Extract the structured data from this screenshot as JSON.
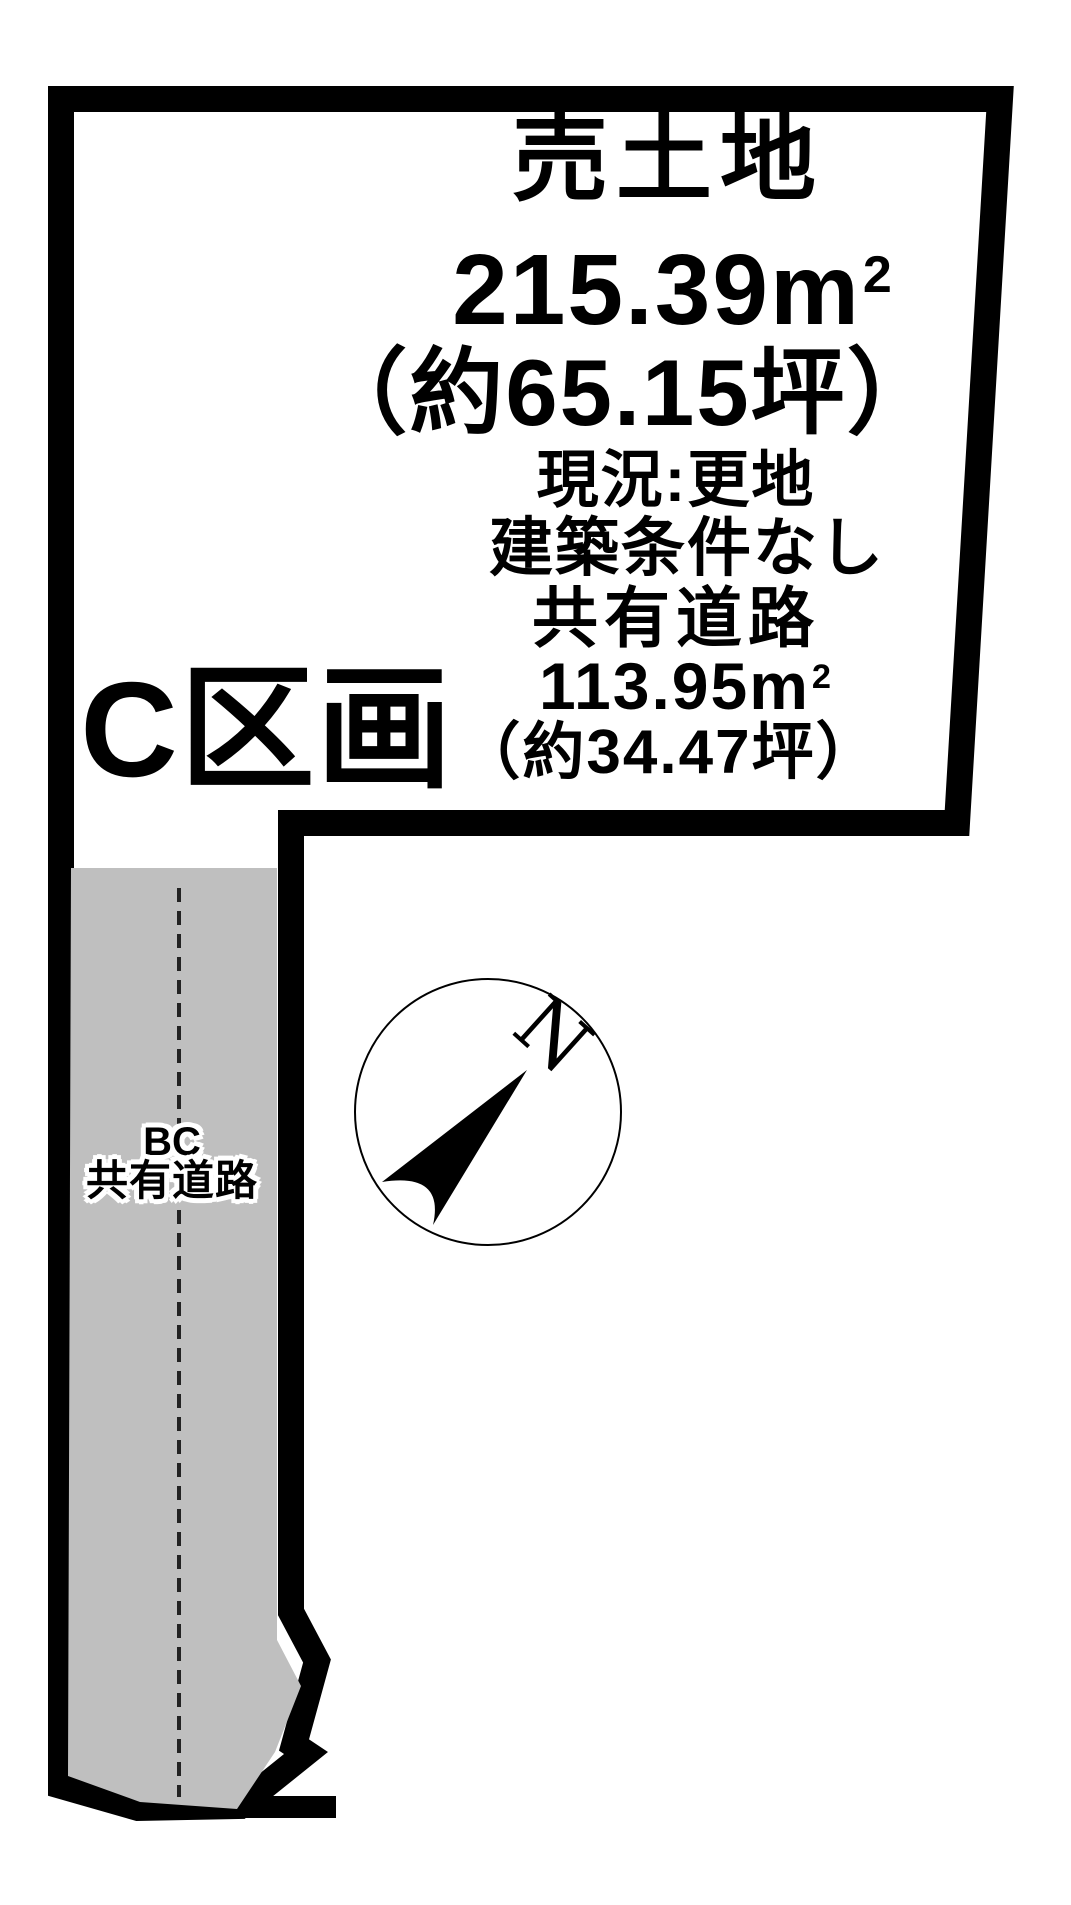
{
  "land": {
    "type_label": "売土地",
    "area_value": "215.39",
    "area_unit": "m",
    "area_unit_sup": "2",
    "area_tsubo": "（約65.15坪）",
    "current_status": "現況:更地",
    "building_condition": "建築条件なし"
  },
  "shared_road": {
    "label": "共有道路",
    "area_value": "113.95",
    "area_unit": "m",
    "area_unit_sup": "2",
    "area_tsubo": "（約34.47坪）"
  },
  "section": {
    "label": "C区画"
  },
  "road_strip": {
    "line1": "BC",
    "line2": "共有道路"
  },
  "compass": {
    "north_label": "N"
  },
  "colors": {
    "outline": "#000000",
    "plot_fill": "#ffffff",
    "road_fill": "#bfbfbf",
    "dash": "#222222",
    "background": "#ffffff",
    "text": "#000000"
  }
}
